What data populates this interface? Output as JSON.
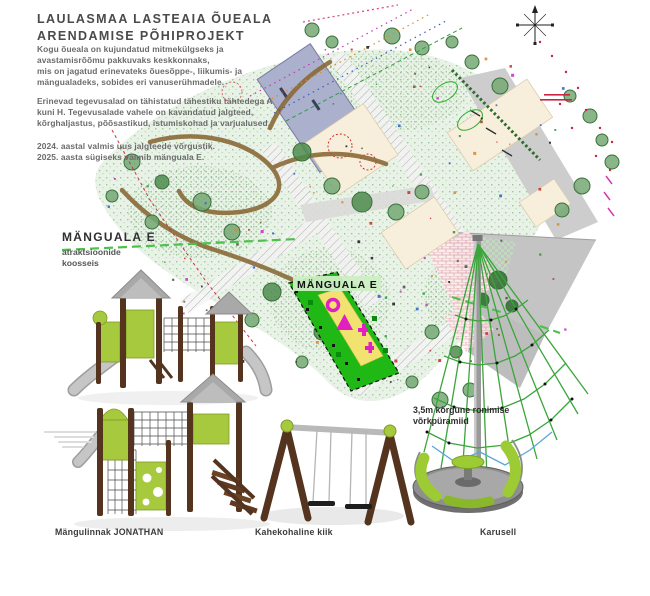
{
  "title": "LAULASMAA LASTEAIA ÕUEALA\nARENDAMISE PÕHIPROJEKT",
  "intro": {
    "p1": "Kogu õueala on kujundatud mitmekülgseks ja\navastamisrõõmu pakkuvaks keskkonnaks,\nmis on jagatud erinevateks õuesõppe-, liikumis- ja\nmängualadeks, sobides eri vanuserühmadele.",
    "p2": "Erinevad tegevusalad on tähistatud tähestiku tähtedega A\nkuni H. Tegevusalade vahele on kavandatud jalgteed,\nkõrghaljastus, põõsastikud, istumiskohad ja varjualused.",
    "p3": "2024. aastal valmis uus jalgteede võrgustik.\n2025. aasta sügiseks valmib mänguala E."
  },
  "area_callout": {
    "title": "MÄNGUALA E",
    "subtitle": "atraktsioonide\nkoosseis"
  },
  "map": {
    "area_tag": "MÄNGUALA E"
  },
  "pyramid_note": "3,5m kõrgune ronimise\nvõrkpüramiid",
  "equipment_labels": {
    "playground": "Mängulinnak JONATHAN",
    "swing": "Kahekohaline kiik",
    "carousel": "Karusell"
  },
  "colors": {
    "zone_green": "#1fb814",
    "zone_label_bg": "#cdeec4",
    "zone_yellow": "#f2e371",
    "symbol_magenta": "#e020c0",
    "equipment_lime": "#a6c93e",
    "wood_brown": "#54341f",
    "slide_gray": "#c6c6c6",
    "net_rope_green": "#3aa53a",
    "road_gray": "#cdcdcd",
    "building_blue": "#abb0cd",
    "boundary_red": "#cc3344",
    "title_text": "#4a4a4a",
    "body_text": "#6b6b6b"
  }
}
